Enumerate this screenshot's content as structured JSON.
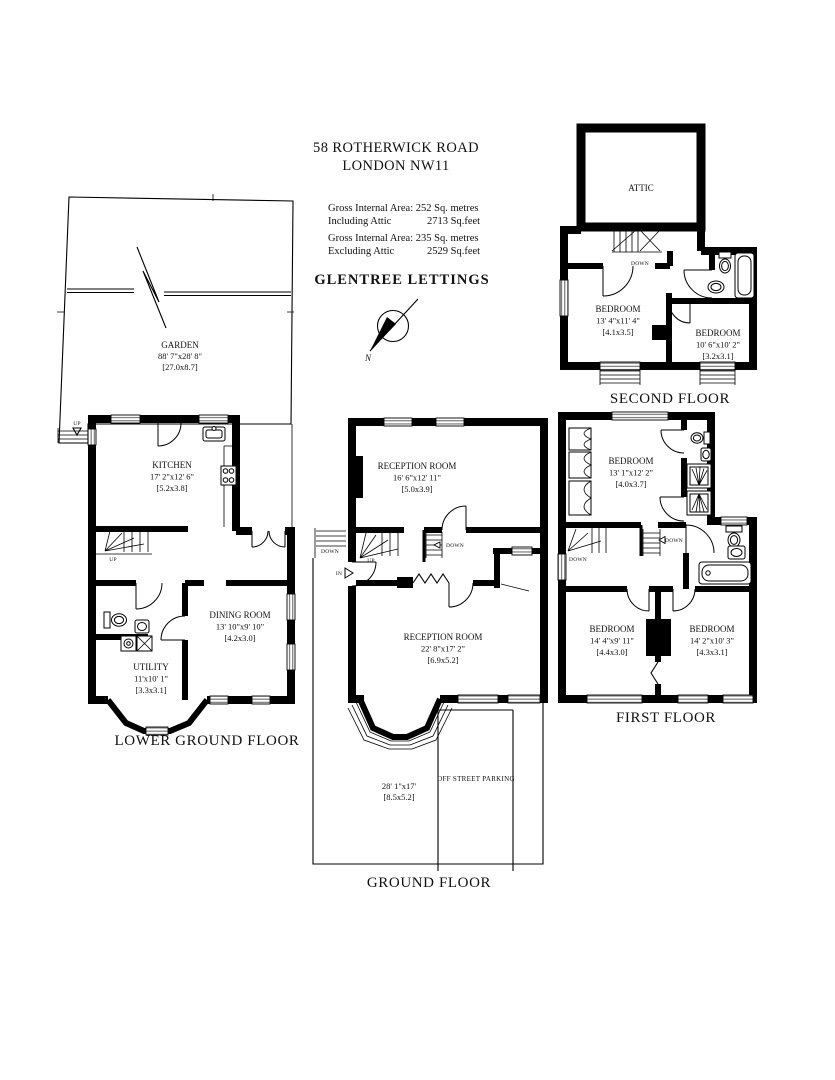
{
  "header": {
    "address_line1": "58 ROTHERWICK ROAD",
    "address_line2": "LONDON NW11",
    "area_incl_line1": "Gross Internal Area: 252 Sq. metres",
    "area_incl_label": "Including Attic",
    "area_incl_value": "2713 Sq.feet",
    "area_excl_line1": "Gross Internal Area: 235 Sq. metres",
    "area_excl_label": "Excluding Attic",
    "area_excl_value": "2529 Sq.feet",
    "agency": "GLENTREE LETTINGS"
  },
  "compass": {
    "north": "N"
  },
  "nav": {
    "up": "UP",
    "down": "DOWN",
    "in": "IN"
  },
  "floors": {
    "lower_ground": {
      "label": "LOWER GROUND FLOOR"
    },
    "ground": {
      "label": "GROUND FLOOR"
    },
    "first": {
      "label": "FIRST FLOOR"
    },
    "second": {
      "label": "SECOND FLOOR"
    }
  },
  "rooms": {
    "garden": {
      "name": "GARDEN",
      "imperial": "88' 7\"x28' 8\"",
      "metric": "[27.0x8.7]"
    },
    "kitchen": {
      "name": "KITCHEN",
      "imperial": "17' 2\"x12' 6\"",
      "metric": "[5.2x3.8]"
    },
    "dining": {
      "name": "DINING ROOM",
      "imperial": "13' 10\"x9' 10\"",
      "metric": "[4.2x3.0]"
    },
    "utility": {
      "name": "UTILITY",
      "imperial": "11'x10' 1\"",
      "metric": "[3.3x3.1]"
    },
    "reception1": {
      "name": "RECEPTION ROOM",
      "imperial": "16' 6\"x12' 11\"",
      "metric": "[5.0x3.9]"
    },
    "reception2": {
      "name": "RECEPTION ROOM",
      "imperial": "22' 8\"x17' 2\"",
      "metric": "[6.9x5.2]"
    },
    "parking_area": {
      "imperial": "28' 1\"x17'",
      "metric": "[8.5x5.2]"
    },
    "off_street_parking": {
      "name": "OFF STREET PARKING"
    },
    "bedroom_ff_top": {
      "name": "BEDROOM",
      "imperial": "13' 1\"x12' 2\"",
      "metric": "[4.0x3.7]"
    },
    "bedroom_ff_left": {
      "name": "BEDROOM",
      "imperial": "14' 4\"x9' 11\"",
      "metric": "[4.4x3.0]"
    },
    "bedroom_ff_right": {
      "name": "BEDROOM",
      "imperial": "14' 2\"x10' 3\"",
      "metric": "[4.3x3.1]"
    },
    "attic": {
      "name": "ATTIC"
    },
    "bedroom_sf_left": {
      "name": "BEDROOM",
      "imperial": "13' 4\"x11' 4\"",
      "metric": "[4.1x3.5]"
    },
    "bedroom_sf_right": {
      "name": "BEDROOM",
      "imperial": "10' 6\"x10' 2\"",
      "metric": "[3.2x3.1]"
    }
  }
}
